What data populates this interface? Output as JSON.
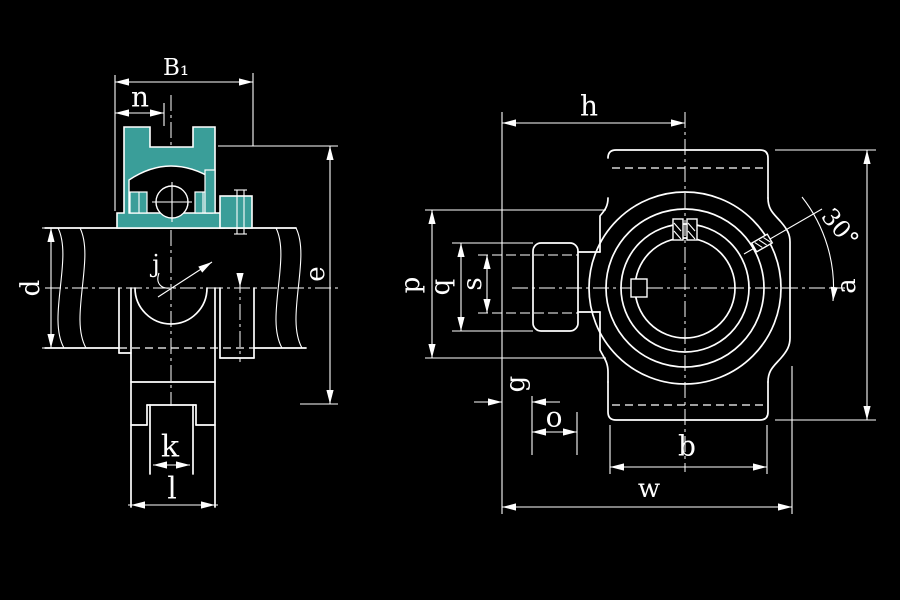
{
  "drawing": {
    "type": "bearing take-up unit engineering drawing, two orthographic views",
    "colors": {
      "background": "#000000",
      "line": "#FFFFFF",
      "section_highlight": "#3A9E99"
    },
    "labels": {
      "B1": "B₁",
      "n": "n",
      "d": "d",
      "e": "e",
      "j": "j",
      "k": "k",
      "l": "l",
      "h": "h",
      "p": "p",
      "q": "q",
      "s": "s",
      "g": "g",
      "o": "o",
      "b": "b",
      "w": "w",
      "a": "a",
      "angle": "30°"
    }
  }
}
